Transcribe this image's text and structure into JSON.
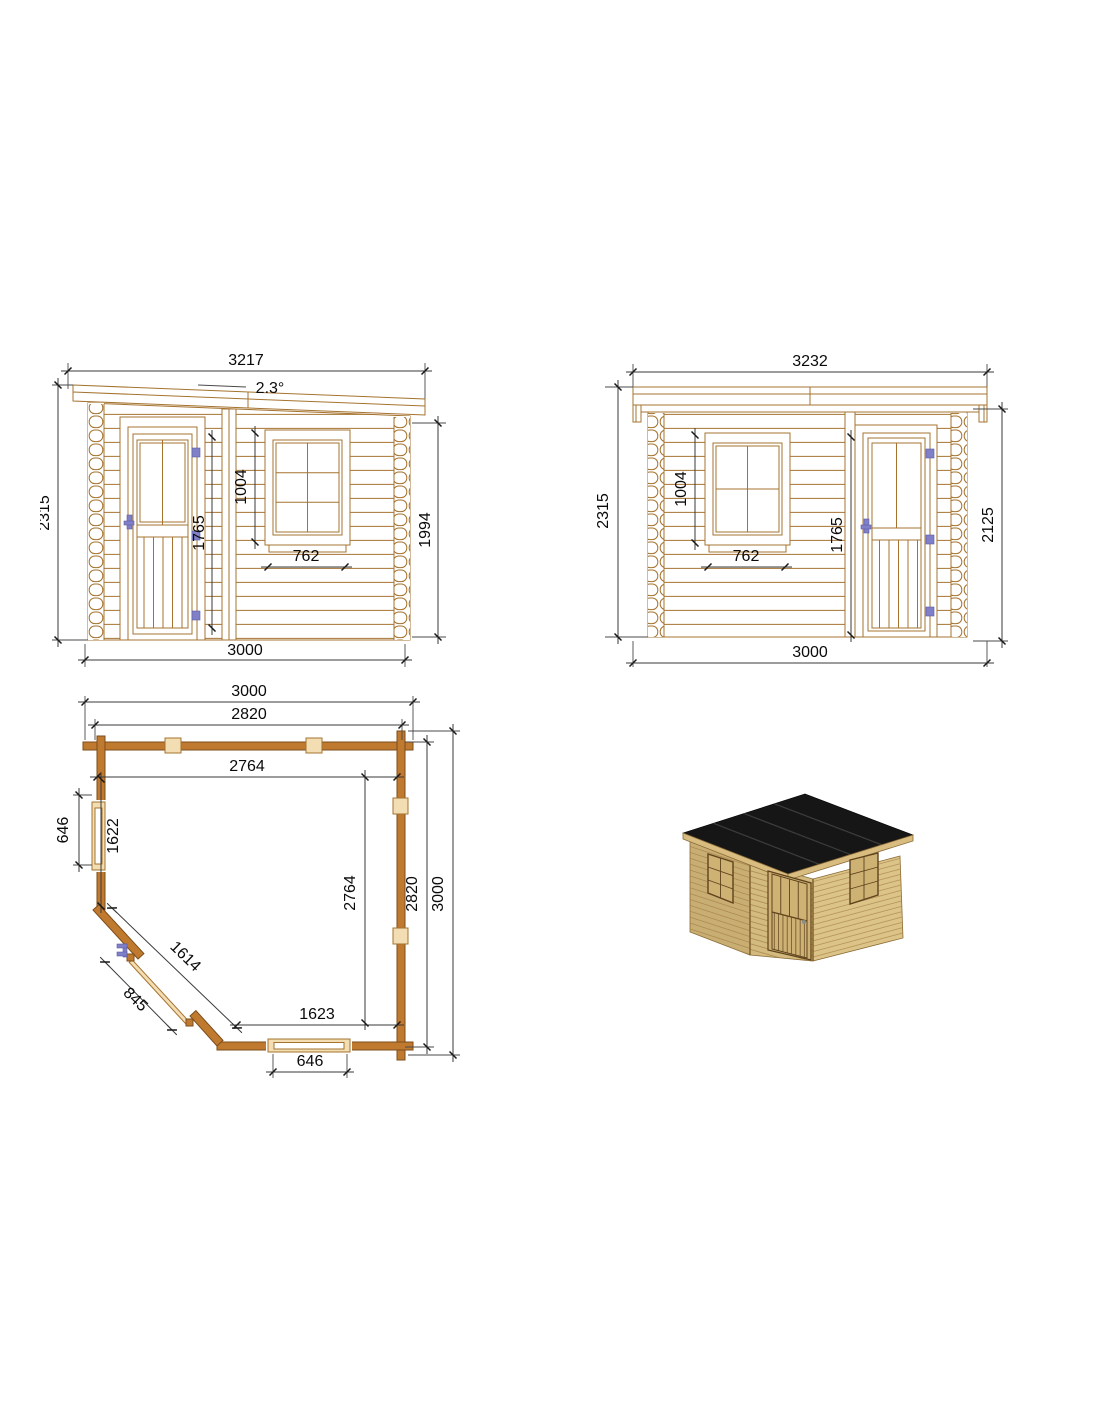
{
  "colors": {
    "wood_line": "#a5732f",
    "dimension_line": "#3a3a3a",
    "text": "#0a0a0a",
    "hardware_blue": "#8080c8",
    "plan_wall_fill": "#c07a30",
    "roof_black": "#161616",
    "render_wall_tan": "#d3ba7e"
  },
  "front_elevation": {
    "roof_width": "3217",
    "roof_angle": "2.3°",
    "overall_height": "2315",
    "door_height": "1765",
    "window_height": "1004",
    "window_width": "762",
    "side_wall_height": "1994",
    "wall_width": "3000"
  },
  "rear_elevation": {
    "roof_width": "3232",
    "overall_height": "2315",
    "window_height": "1004",
    "window_width": "762",
    "door_height": "1765",
    "side_wall_height": "2125",
    "wall_width": "3000"
  },
  "floor_plan": {
    "overall_width": "3000",
    "outer_width": "2820",
    "inner_width": "2764",
    "side_window_width": "646",
    "side_wall_length": "1622",
    "inner_depth": "2764",
    "outer_depth": "2820",
    "overall_depth": "3000",
    "corner_wall_length": "1614",
    "door_width": "845",
    "front_inner_width": "1623",
    "front_window_width": "646"
  }
}
